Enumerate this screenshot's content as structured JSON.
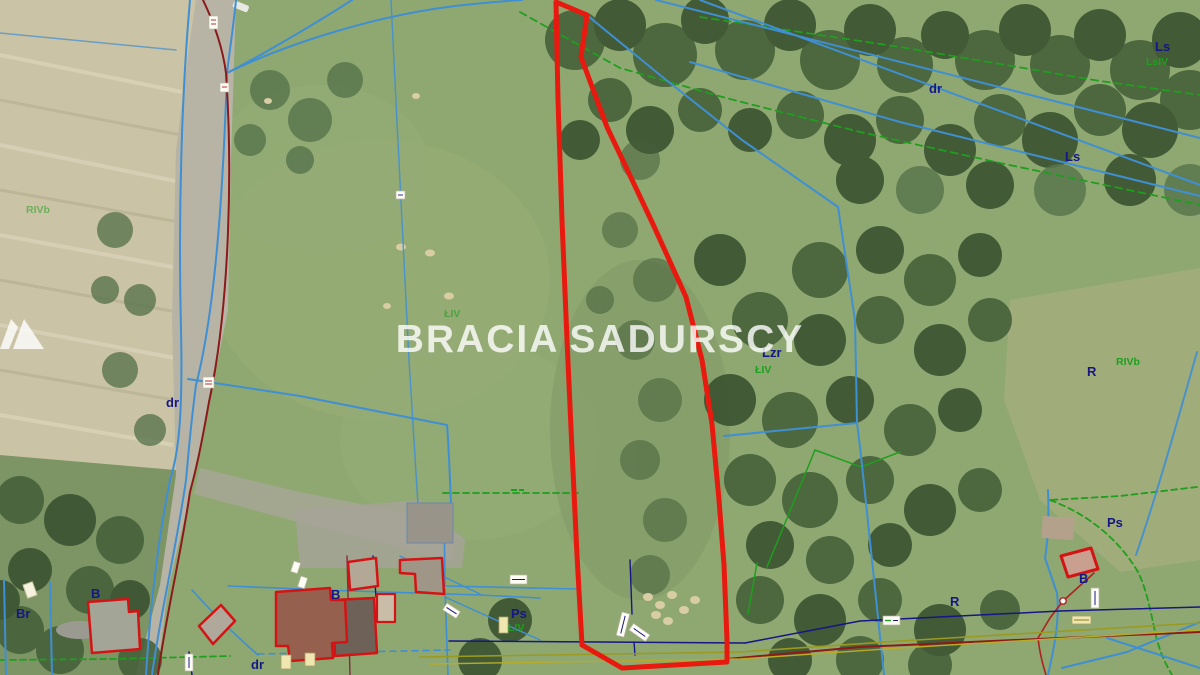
{
  "watermark": {
    "brand_left": "BRACIA",
    "brand_right": "SADURSCY",
    "logo": "twin-peaks-icon",
    "color": "#ffffff"
  },
  "map": {
    "type": "aerial-cadastral-parcel-view",
    "palette": {
      "parcel_outline_red": "#e8190f",
      "cadastral_blue": "#3f8fd2",
      "land_use_green": "#1f9e1f",
      "label_navy": "#161685",
      "road_line_dark_red": "#8b1a1a",
      "utility_olive": "#9a9a20",
      "meadow_green": "#8fa871",
      "forest_green": "#46603a",
      "road_grey": "#b7b4a6",
      "field_tan": "#cbc3a5"
    },
    "labels": [
      {
        "text": "dr",
        "kind": "road"
      },
      {
        "text": "dr",
        "kind": "road"
      },
      {
        "text": "dr",
        "kind": "road"
      },
      {
        "text": "Ls",
        "kind": "forest"
      },
      {
        "text": "LsIV",
        "kind": "forest-class"
      },
      {
        "text": "Ls",
        "kind": "forest"
      },
      {
        "text": "Lzr",
        "kind": "afforested"
      },
      {
        "text": "ŁIV",
        "kind": "meadow-class"
      },
      {
        "text": "ŁIV",
        "kind": "meadow-class"
      },
      {
        "text": "R",
        "kind": "arable"
      },
      {
        "text": "RIVb",
        "kind": "arable-class"
      },
      {
        "text": "R",
        "kind": "arable"
      },
      {
        "text": "Ps",
        "kind": "pasture"
      },
      {
        "text": "Ps",
        "kind": "pasture"
      },
      {
        "text": "ŁIV",
        "kind": "meadow-class"
      },
      {
        "text": "B",
        "kind": "built-up"
      },
      {
        "text": "B",
        "kind": "built-up"
      },
      {
        "text": "B",
        "kind": "built-up"
      },
      {
        "text": "Br",
        "kind": "built-arable"
      },
      {
        "text": "RIVb",
        "kind": "arable-class"
      }
    ]
  }
}
